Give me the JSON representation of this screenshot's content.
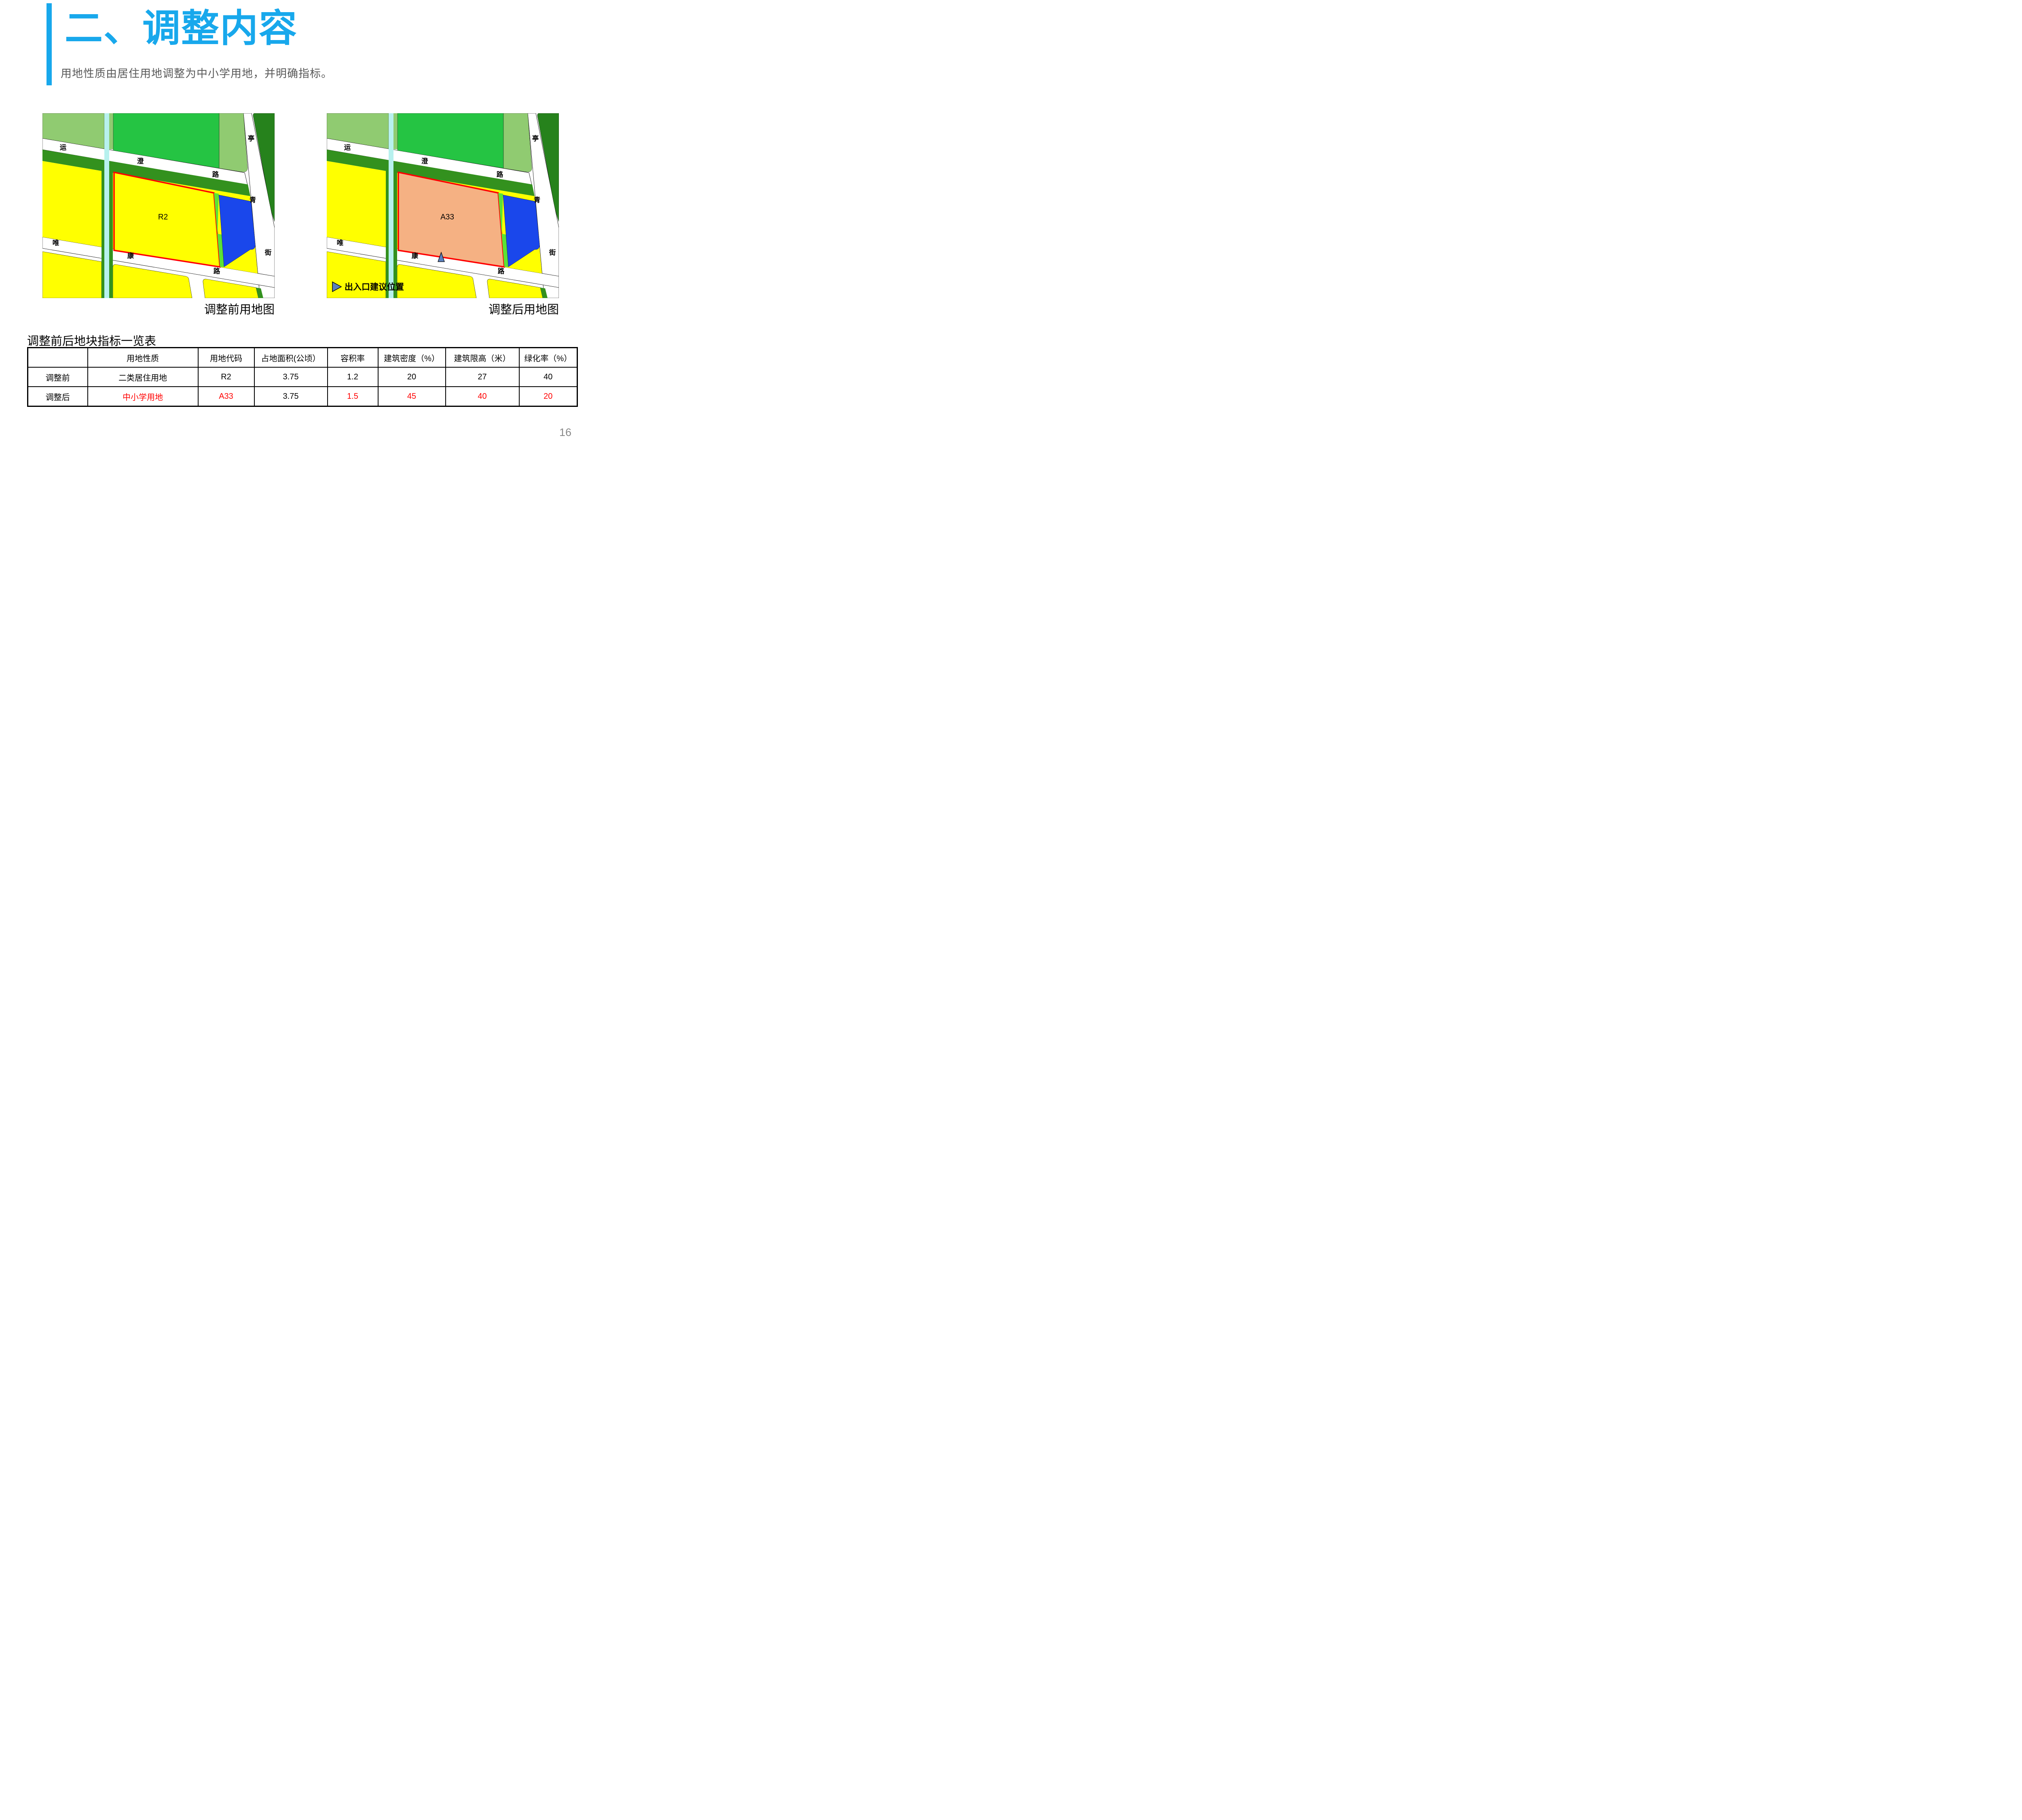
{
  "header": {
    "title": "二、调整内容",
    "subtitle": "用地性质由居住用地调整为中小学用地，并明确指标。",
    "accent_color": "#18A8EC"
  },
  "maps": {
    "street_labels": [
      "运",
      "澄",
      "路",
      "亭",
      "青",
      "街",
      "唯",
      "康",
      "路"
    ],
    "before": {
      "caption": "调整前用地图",
      "parcel_label": "R2",
      "parcel_fill": "#FFFF00"
    },
    "after": {
      "caption": "调整后用地图",
      "parcel_label": "A33",
      "parcel_fill": "#F5B183",
      "entrance_legend": "出入口建议位置"
    },
    "colors": {
      "light_green": "#90CB71",
      "bright_green": "#25C443",
      "dark_green": "#33911E",
      "forest_green": "#26821C",
      "canal": "#B7F1EE",
      "yellow": "#FFFF00",
      "blue": "#1A47EB",
      "lime": "#5BE335",
      "red_outline": "#FF0000",
      "marker_blue": "#5B80BE",
      "road": "#FFFFFF"
    }
  },
  "table": {
    "title": "调整前后地块指标一览表",
    "headers": [
      "",
      "用地性质",
      "用地代码",
      "占地面积(公顷）",
      "容积率",
      "建筑密度（%）",
      "建筑限高（米）",
      "绿化率（%）"
    ],
    "rows": [
      {
        "label": "调整前",
        "cells": [
          "二类居住用地",
          "R2",
          "3.75",
          "1.2",
          "20",
          "27",
          "40"
        ]
      },
      {
        "label": "调整后",
        "cells": [
          "中小学用地",
          "A33",
          "3.75",
          "1.5",
          "45",
          "40",
          "20"
        ]
      }
    ]
  },
  "page_number": "16"
}
